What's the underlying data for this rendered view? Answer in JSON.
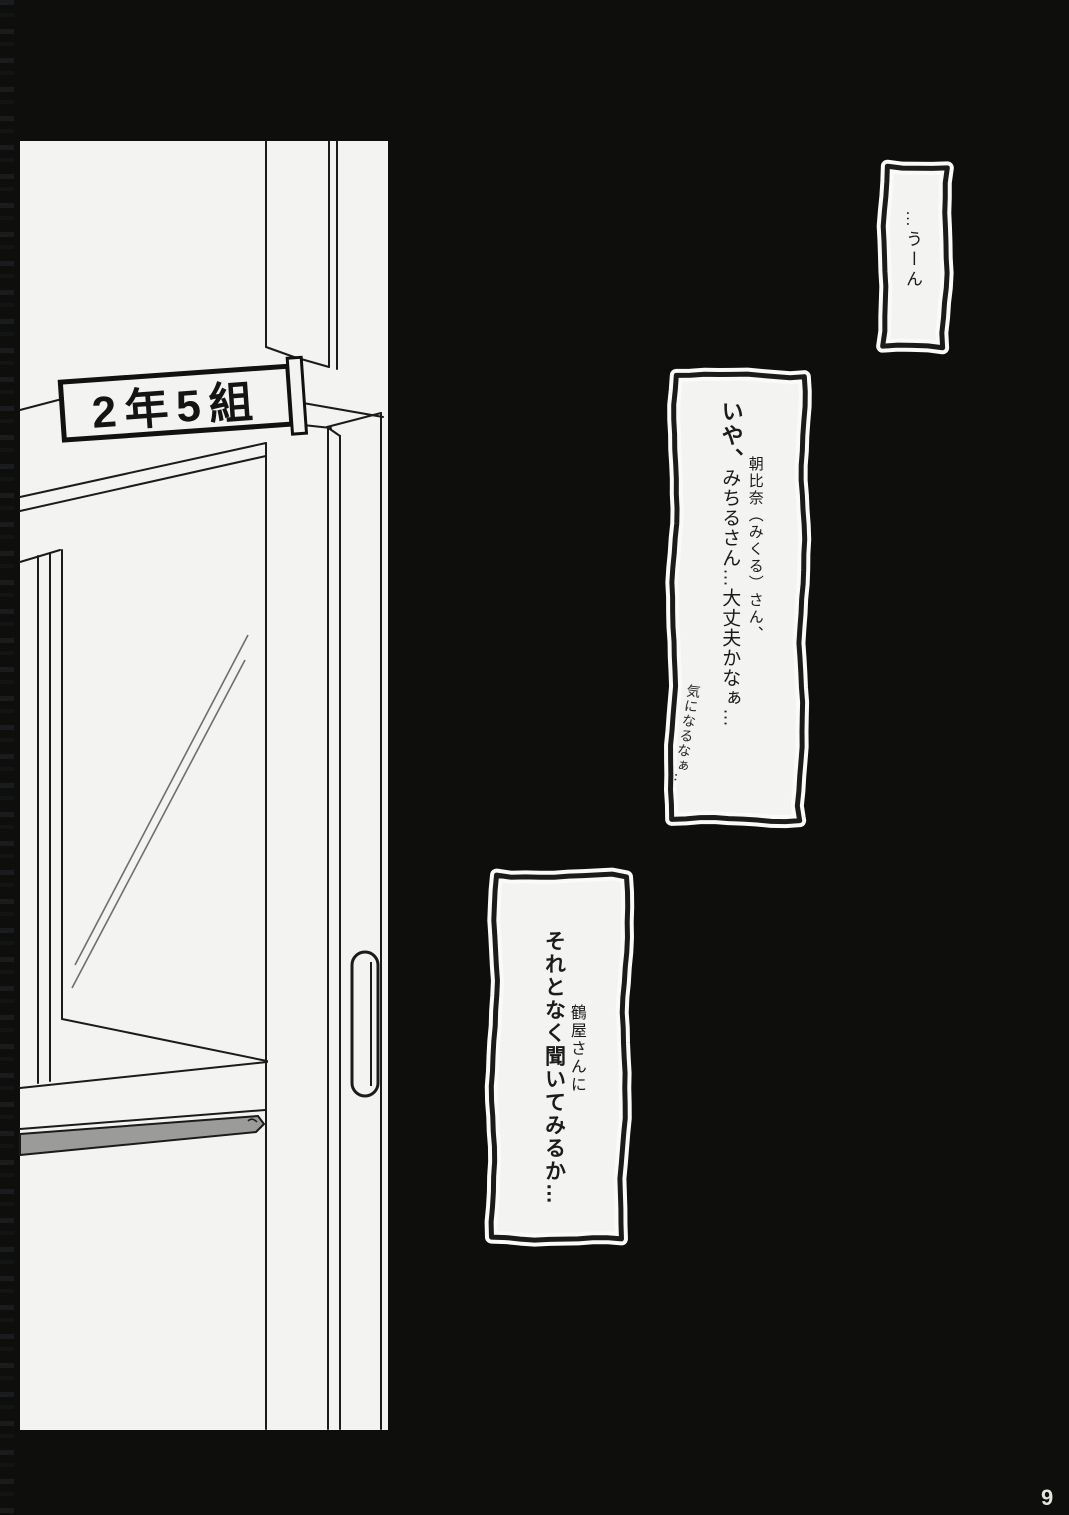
{
  "door": {
    "sign_label": "2年5組"
  },
  "bubbles": {
    "b1": {
      "text": "…うーん"
    },
    "b2": {
      "line1": "いや、",
      "line2": "朝比奈（みくる）さん、",
      "line3": "みちるさん…大丈夫かなぁ…",
      "handwritten": "気になるなぁ‥"
    },
    "b3": {
      "line1": "鶴屋さんに",
      "line2": "それとなく聞いてみるか…"
    }
  },
  "page_number": "9",
  "colors": {
    "background": "#0e0e0c",
    "paper": "#f3f3f1",
    "ink": "#1b1b1b",
    "kickplate": "#9b9b99"
  }
}
